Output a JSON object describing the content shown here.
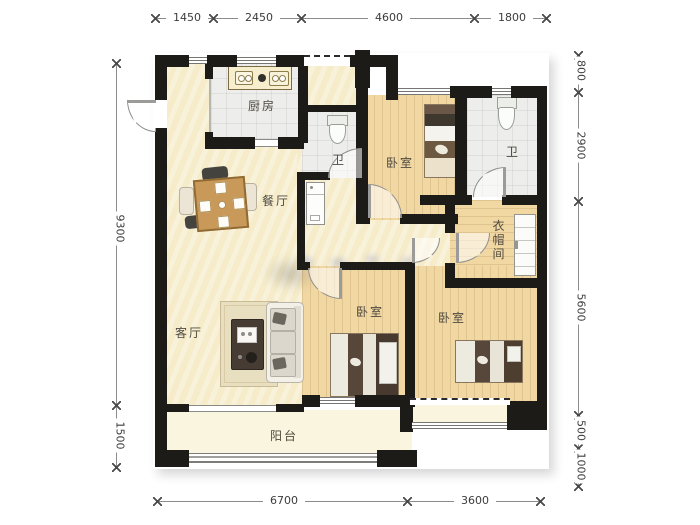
{
  "rooms": {
    "kitchen": "厨房",
    "dining": "餐厅",
    "bath_mid": "卫",
    "bedroom_top": "卧室",
    "bath_right": "卫",
    "cloakroom": "衣帽间",
    "living": "客厅",
    "bedroom_center": "卧室",
    "bedroom_right": "卧室",
    "balcony": "阳台"
  },
  "dimensions": {
    "top": [
      "1450",
      "2450",
      "4600",
      "1800"
    ],
    "bottom": [
      "6700",
      "3600"
    ],
    "left": [
      "9300",
      "1500"
    ],
    "right": [
      "800",
      "2900",
      "5600",
      "500",
      "1000"
    ]
  },
  "colors": {
    "wall": "#1d1b18",
    "floor_cream": "#f6ecca",
    "floor_wood": "#f1d7a2",
    "floor_tile": "#ededeb",
    "floor_balcony": "#f9f5df",
    "dim_text": "#3c3c3c",
    "label_text": "#4f4a40"
  }
}
